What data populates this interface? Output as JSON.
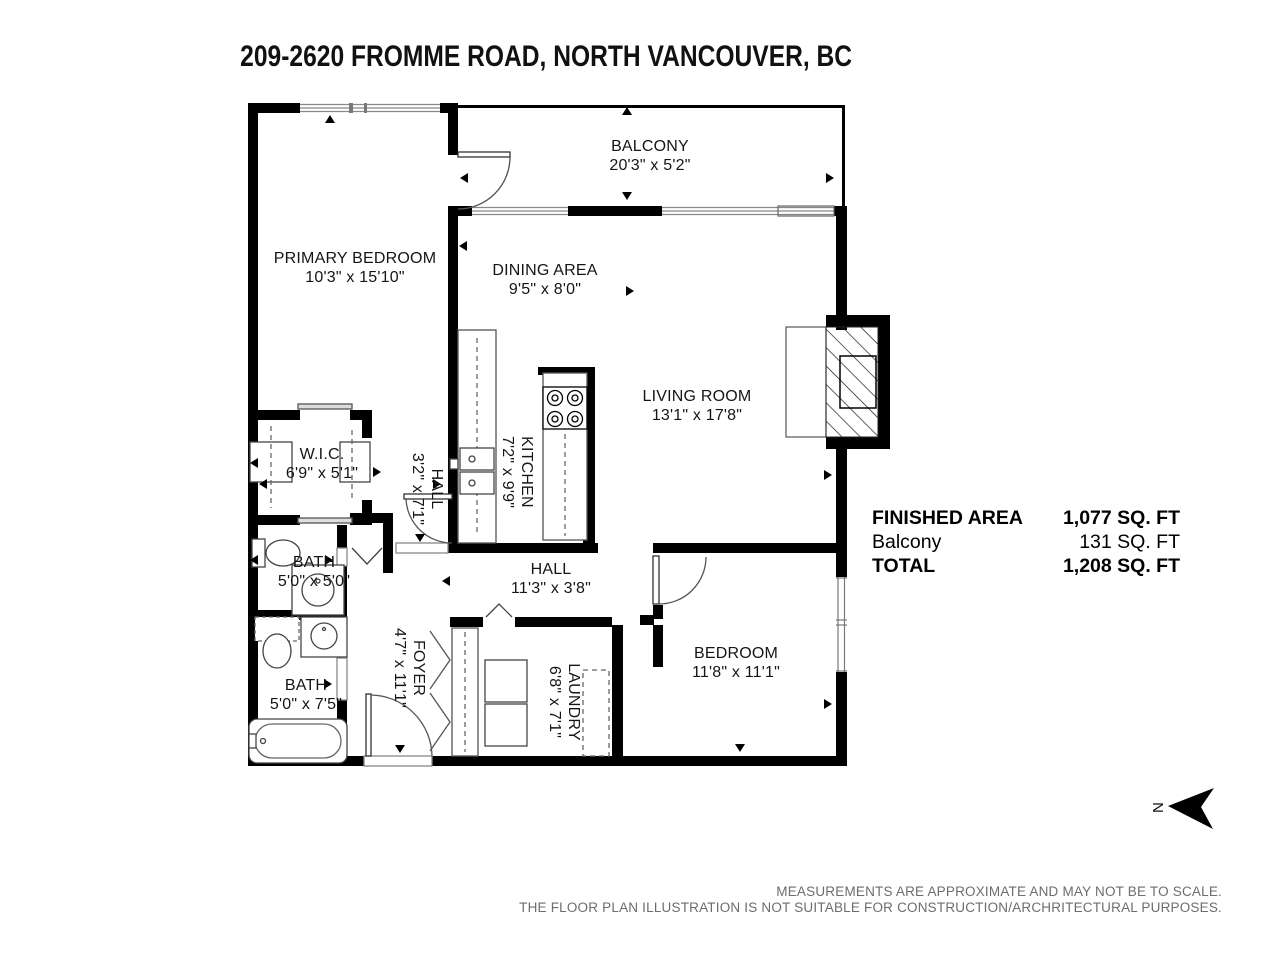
{
  "title": "209-2620 FROMME ROAD, NORTH VANCOUVER, BC",
  "rooms": [
    {
      "name": "BALCONY",
      "dims": "20'3\" x 5'2\""
    },
    {
      "name": "PRIMARY BEDROOM",
      "dims": "10'3\" x 15'10\""
    },
    {
      "name": "DINING AREA",
      "dims": "9'5\" x 8'0\""
    },
    {
      "name": "LIVING ROOM",
      "dims": "13'1\" x 17'8\""
    },
    {
      "name": "W.I.C.",
      "dims": "6'9\" x 5'1\""
    },
    {
      "name": "HALL",
      "dims": "3'2\" x 7'1\""
    },
    {
      "name": "KITCHEN",
      "dims": "7'2\" x 9'9\""
    },
    {
      "name": "BATH",
      "dims": "5'0\" x 5'0\""
    },
    {
      "name": "HALL",
      "dims": "11'3\" x 3'8\""
    },
    {
      "name": "BATH",
      "dims": "5'0\" x 7'5\""
    },
    {
      "name": "FOYER",
      "dims": "4'7\" x 11'1\""
    },
    {
      "name": "LAUNDRY",
      "dims": "6'8\" x 7'1\""
    },
    {
      "name": "BEDROOM",
      "dims": "11'8\" x 11'1\""
    }
  ],
  "area_table": {
    "rows": [
      {
        "label": "FINISHED AREA",
        "value": "1,077 SQ. FT"
      },
      {
        "label": "Balcony",
        "value": "131 SQ. FT"
      },
      {
        "label": "TOTAL",
        "value": "1,208 SQ. FT"
      }
    ]
  },
  "compass": {
    "label": "N"
  },
  "disclaimer": {
    "line1": "MEASUREMENTS ARE APPROXIMATE AND MAY NOT BE TO SCALE.",
    "line2": "THE FLOOR PLAN ILLUSTRATION IS NOT SUITABLE FOR CONSTRUCTION/ARCHRITECTURAL PURPOSES."
  },
  "colors": {
    "wall": "#000000",
    "window": "#888888",
    "fixture": "#444444",
    "text_gray": "#6d6d6d"
  }
}
